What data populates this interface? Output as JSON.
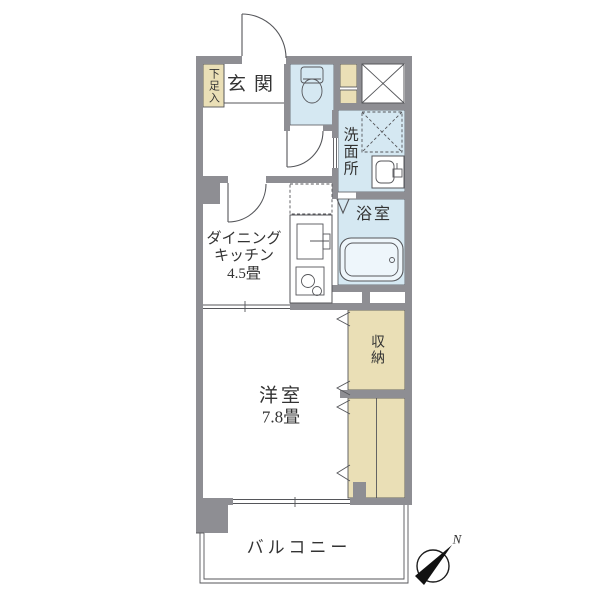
{
  "document_type": "japanese-apartment-floor-plan",
  "colors": {
    "wall": "#8e8e93",
    "wet": "#d5e8f2",
    "storage": "#eadfb6",
    "line": "#55565a",
    "text": "#333333",
    "bg": "#ffffff",
    "tub": "#eef6fb"
  },
  "rooms": {
    "entrance": {
      "name": "玄関"
    },
    "shoe_cabinet": {
      "name": "下足入"
    },
    "toilet_room": {
      "name": ""
    },
    "washroom": {
      "name": "洗面所"
    },
    "bathroom": {
      "name": "浴室"
    },
    "dining_kitchen": {
      "name_line1": "ダイニング",
      "name_line2": "キッチン",
      "area": "4.5畳"
    },
    "western_room": {
      "name": "洋室",
      "area": "7.8畳"
    },
    "storage": {
      "name": "収納"
    },
    "balcony": {
      "name": "バルコニー"
    }
  },
  "compass": {
    "north_label": "N"
  },
  "icons": [
    "entrance-door-swing-icon",
    "toilet-icon",
    "toilet-door-swing-icon",
    "pipe-space-cross-icon",
    "washing-machine-space-icon",
    "vanity-sink-icon",
    "bathroom-folding-door-icon",
    "bathtub-icon",
    "refrigerator-space-icon",
    "kitchen-sink-icon",
    "kitchen-faucet-icon",
    "stove-icon",
    "dk-door-swing-icon",
    "folding-door-marks-icon",
    "sliding-opening-icon",
    "balcony-window-icon",
    "compass-icon"
  ]
}
